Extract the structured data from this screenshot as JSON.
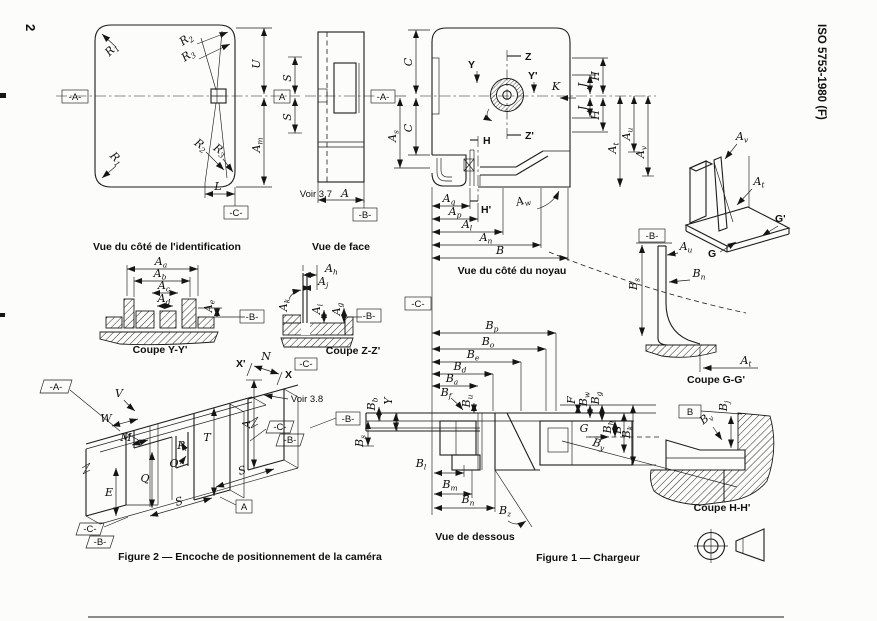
{
  "page": {
    "number": "2",
    "standard": "ISO 5753-1980 (F)"
  },
  "captions": {
    "identification": "Vue du côté de l'identification",
    "face": "Vue de face",
    "noyau": "Vue du côté du noyau",
    "coupe_yy": "Coupe Y-Y'",
    "coupe_zz": "Coupe Z-Z'",
    "coupe_gg": "Coupe G-G'",
    "coupe_hh": "Coupe H-H'",
    "dessous": "Vue de dessous",
    "figure1": "Figure 1 — Chargeur",
    "figure2": "Figure 2 — Encoche de positionnement de la caméra"
  },
  "notes": {
    "voir37": "Voir 3.7",
    "voir38": "Voir 3.8"
  },
  "datums": {
    "A_ref": "-A-",
    "B_ref": "-B-",
    "C_ref": "-C-",
    "A_box": "A",
    "B_box": "B"
  },
  "labels": {
    "R1": {
      "m": "R",
      "s": "1"
    },
    "R2": {
      "m": "R",
      "s": "2"
    },
    "R3": {
      "m": "R",
      "s": "3"
    },
    "L": {
      "m": "L",
      "s": ""
    },
    "U": {
      "m": "U",
      "s": ""
    },
    "Am": {
      "m": "A",
      "s": "m"
    },
    "S": {
      "m": "S",
      "s": ""
    },
    "A": {
      "m": "A",
      "s": ""
    },
    "C": {
      "m": "C",
      "s": ""
    },
    "As": {
      "m": "A",
      "s": "s"
    },
    "K": {
      "m": "K",
      "s": ""
    },
    "J": {
      "m": "J",
      "s": ""
    },
    "H": {
      "m": "H",
      "s": ""
    },
    "Hp": {
      "m": "H'",
      "s": ""
    },
    "Z": {
      "m": "Z",
      "s": ""
    },
    "Zp": {
      "m": "Z'",
      "s": ""
    },
    "Y": {
      "m": "Y",
      "s": ""
    },
    "Yp": {
      "m": "Y'",
      "s": ""
    },
    "At": {
      "m": "A",
      "s": "t"
    },
    "Au": {
      "m": "A",
      "s": "u"
    },
    "Av": {
      "m": "A",
      "s": "v"
    },
    "Aw": {
      "m": "A",
      "s": "w"
    },
    "Aq": {
      "m": "A",
      "s": "q"
    },
    "Ap": {
      "m": "A",
      "s": "p"
    },
    "Al": {
      "m": "A",
      "s": "l"
    },
    "An": {
      "m": "A",
      "s": "n"
    },
    "B": {
      "m": "B",
      "s": ""
    },
    "Aa": {
      "m": "A",
      "s": "a"
    },
    "Ab": {
      "m": "A",
      "s": "b"
    },
    "Ac": {
      "m": "A",
      "s": "c"
    },
    "Ad": {
      "m": "A",
      "s": "d"
    },
    "Ae": {
      "m": "A",
      "s": "e"
    },
    "Ah": {
      "m": "A",
      "s": "h"
    },
    "Aj": {
      "m": "A",
      "s": "j"
    },
    "Ak": {
      "m": "A",
      "s": "k"
    },
    "Ai": {
      "m": "A",
      "s": "i"
    },
    "Ag": {
      "m": "A",
      "s": "g"
    },
    "G": {
      "m": "G",
      "s": ""
    },
    "Gp": {
      "m": "G'",
      "s": ""
    },
    "Bs": {
      "m": "B",
      "s": "s"
    },
    "Bn": {
      "m": "B",
      "s": "n"
    },
    "Bp": {
      "m": "B",
      "s": "p"
    },
    "Bo": {
      "m": "B",
      "s": "o"
    },
    "Be": {
      "m": "B",
      "s": "e"
    },
    "Bd": {
      "m": "B",
      "s": "d"
    },
    "Ba": {
      "m": "B",
      "s": "a"
    },
    "Bf": {
      "m": "B",
      "s": "f"
    },
    "Bu": {
      "m": "B",
      "s": "u"
    },
    "Bb": {
      "m": "B",
      "s": "b"
    },
    "Bl": {
      "m": "B",
      "s": "l"
    },
    "Bm": {
      "m": "B",
      "s": "m"
    },
    "Bz": {
      "m": "B",
      "s": "z"
    },
    "F": {
      "m": "F",
      "s": ""
    },
    "Bw": {
      "m": "B",
      "s": "w"
    },
    "Bg": {
      "m": "B",
      "s": "g"
    },
    "Bh": {
      "m": "B",
      "s": "h"
    },
    "Bk": {
      "m": "B",
      "s": "k"
    },
    "By": {
      "m": "B",
      "s": "y"
    },
    "Bj": {
      "m": "B",
      "s": "j"
    },
    "Bv": {
      "m": "B",
      "s": "v"
    },
    "V": {
      "m": "V",
      "s": ""
    },
    "W": {
      "m": "W",
      "s": ""
    },
    "M": {
      "m": "M",
      "s": ""
    },
    "P": {
      "m": "P",
      "s": ""
    },
    "O": {
      "m": "O",
      "s": ""
    },
    "Q": {
      "m": "Q",
      "s": ""
    },
    "E": {
      "m": "E",
      "s": ""
    },
    "T": {
      "m": "T",
      "s": ""
    },
    "N": {
      "m": "N",
      "s": ""
    },
    "X": {
      "m": "X",
      "s": ""
    },
    "Xp": {
      "m": "X'",
      "s": ""
    }
  }
}
